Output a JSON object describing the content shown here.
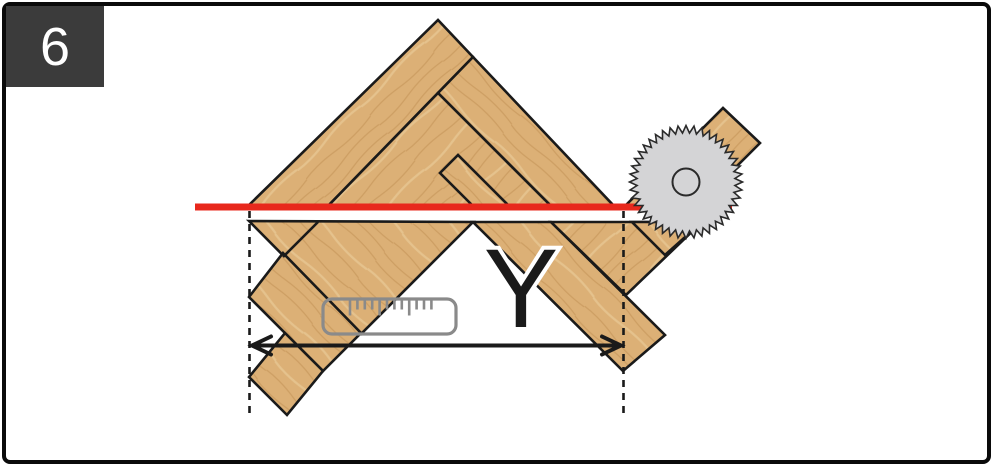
{
  "title": "herringbone-floor-cutting-step",
  "badge": {
    "step_label": "6"
  },
  "dimension": {
    "label": "Y"
  },
  "icons": {
    "saw_blade": "saw-blade-icon",
    "ruler": "ruler-icon"
  },
  "colors": {
    "frame": "#0a0a0a",
    "badge_bg": "#3b3b3b",
    "badge_fg": "#ffffff",
    "wood_base": "#dcb076",
    "wood_grain_dark": "#c6985c",
    "wood_grain_light": "#e9cb97",
    "plank_outline": "#1a1a1a",
    "cut_line_red": "#e8281c",
    "blade_gray": "#d4d4d6",
    "blade_outline": "#2a2a2a",
    "ruler_gray": "#8a8a8a",
    "ink": "#1a1a1a"
  }
}
